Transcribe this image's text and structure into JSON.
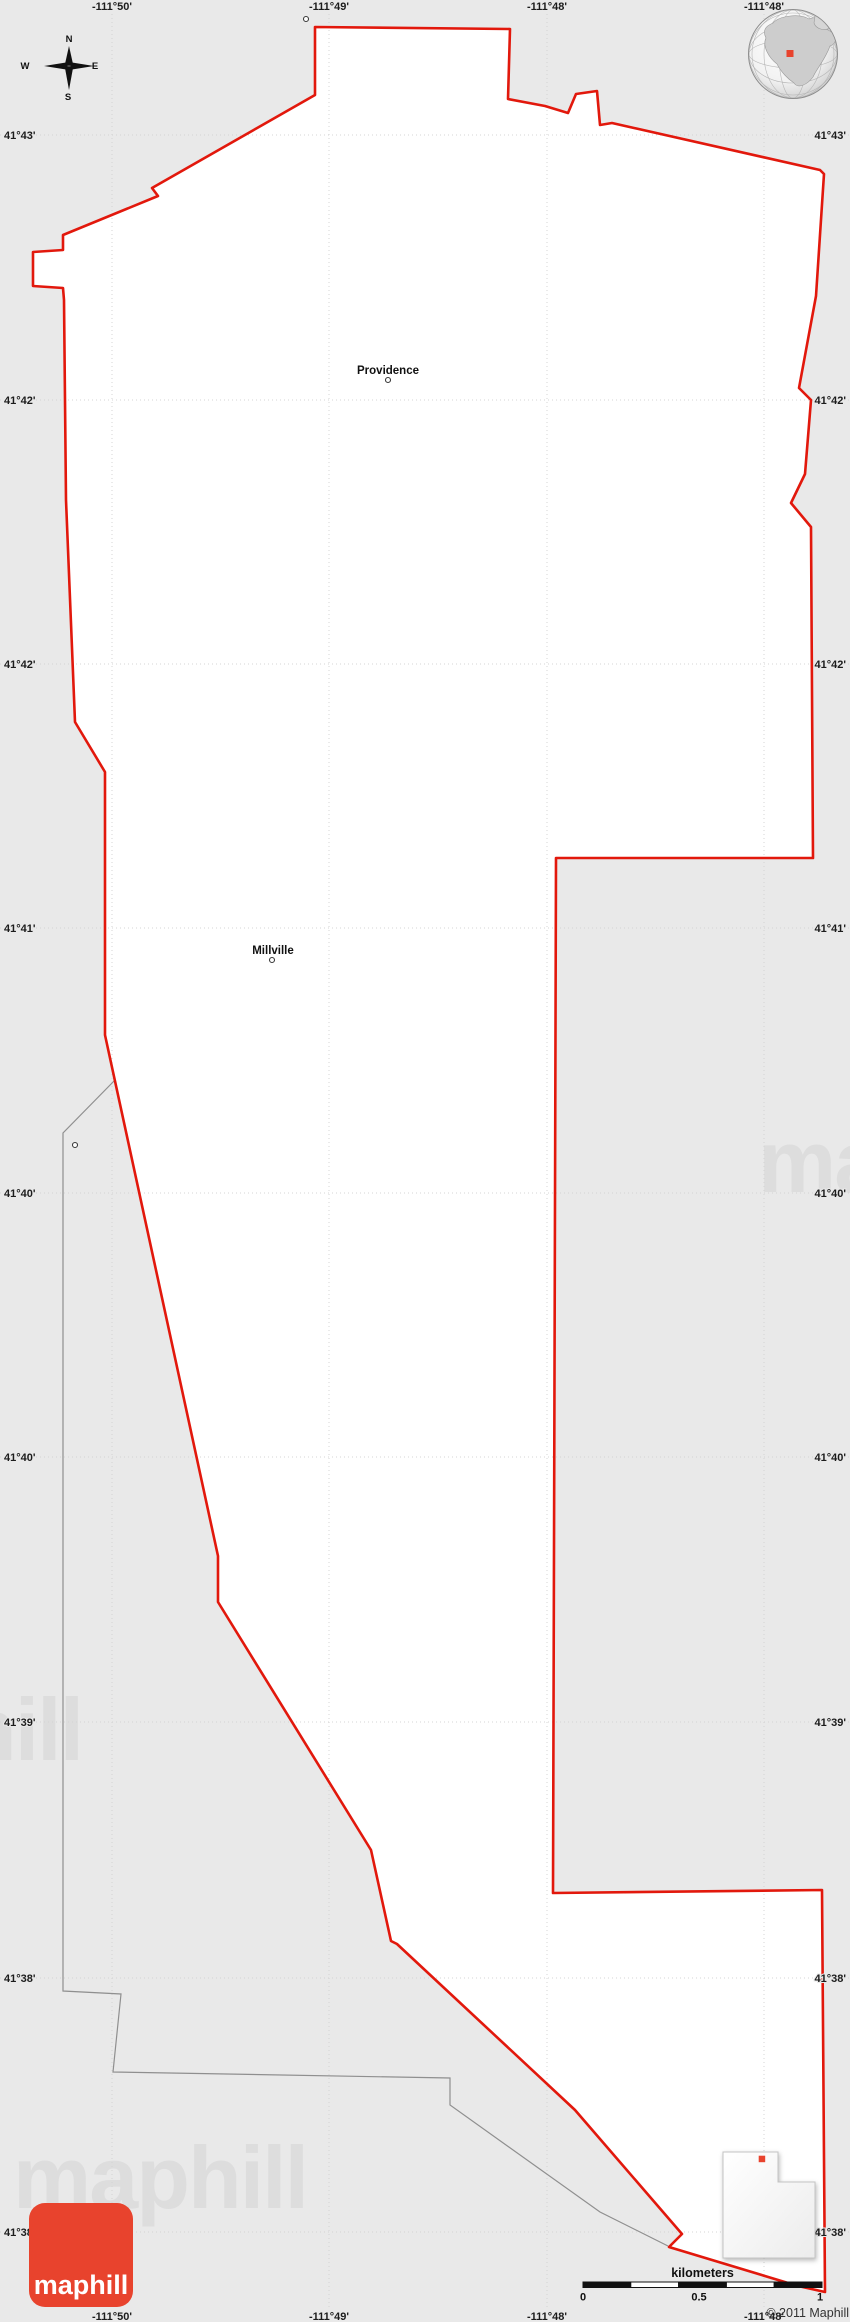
{
  "map": {
    "region_fill": "#ffffff",
    "background": "#e9e9e9",
    "boundary_color": "#e2180c",
    "admin_line_color": "#8f8f8f",
    "grid_color": "#d4d4d4",
    "boundary_points": "315,27 510,29 508,99 545,106 568,113 576,94 597,91 600,125 612,123 820,170 824,174 816,296 799,388 811,400 805,474 791,503 811,527 813,858 556,858 553,1893 822,1890 825,2292 798,2286 669,2247 682,2234 575,2110 397,1944 391,1941 371,1850 218,1602 218,1556 105,1035 105,772 75,722 66,500 64,300 63,288 33,286 33,252 63,250 63,235 158,196 152,188 315,95",
    "admin_line_points": "115,1080 63,1133 63,1991 121,1994 113,2072 450,2078 450,2105 600,2212 668,2246",
    "grid": {
      "lon_labels": [
        {
          "text": "-111°50'",
          "x": 112
        },
        {
          "text": "-111°49'",
          "x": 329
        },
        {
          "text": "-111°48'",
          "x": 547
        },
        {
          "text": "-111°48'",
          "x": 764
        }
      ],
      "lat_labels": [
        {
          "text": "41°43'",
          "y": 135
        },
        {
          "text": "41°42'",
          "y": 400
        },
        {
          "text": "41°42'",
          "y": 664
        },
        {
          "text": "41°41'",
          "y": 928
        },
        {
          "text": "41°40'",
          "y": 1193
        },
        {
          "text": "41°40'",
          "y": 1457
        },
        {
          "text": "41°39'",
          "y": 1722
        },
        {
          "text": "41°38'",
          "y": 1978
        },
        {
          "text": "41°38'",
          "y": 2232
        }
      ]
    },
    "towns": [
      {
        "name": "Providence",
        "label_x": 388,
        "label_y": 374,
        "marker_x": 388,
        "marker_y": 380
      },
      {
        "name": "Millville",
        "label_x": 273,
        "label_y": 954,
        "marker_x": 272,
        "marker_y": 960
      }
    ],
    "unlabeled_markers": [
      {
        "x": 306,
        "y": 19
      },
      {
        "x": 75,
        "y": 1145
      }
    ],
    "watermark": {
      "text": "maphill",
      "positions": [
        {
          "x": 13,
          "y": 2208
        },
        {
          "x": 758,
          "y": 1192
        },
        {
          "x": -212,
          "y": 1760
        }
      ]
    },
    "compass": {
      "n": "N",
      "s": "S",
      "e": "E",
      "w": "W"
    },
    "scale_bar": {
      "title": "kilometers",
      "x0": 583,
      "x1": 822,
      "bar_y": 2282,
      "bar_h": 5.5,
      "segments": 5,
      "ticks": [
        {
          "label": "0",
          "x": 583
        },
        {
          "label": "0.5",
          "x": 699
        },
        {
          "label": "1",
          "x": 820
        }
      ]
    },
    "copyright": "© 2011 Maphill",
    "logo": {
      "text": "maphill",
      "color": "#e8432d"
    },
    "globe": {
      "marker_color": "#e8432d"
    },
    "inset": {
      "state": "Utah",
      "dot_color": "#e8432d"
    }
  }
}
